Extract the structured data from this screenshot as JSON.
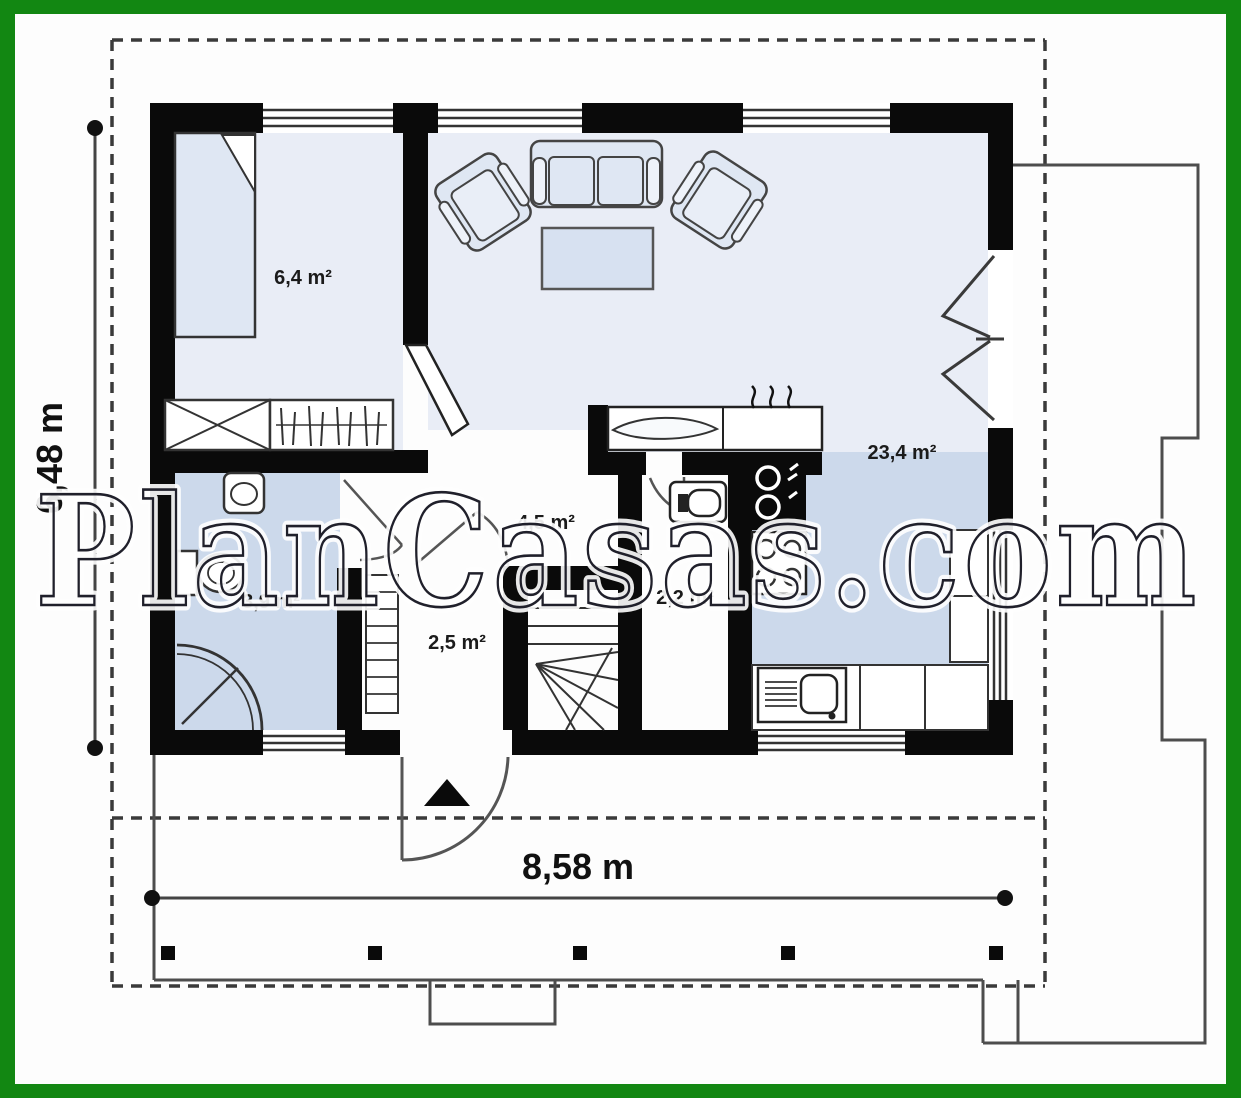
{
  "title": "House ground floor plan",
  "watermark": {
    "text": "PlanCasas.com"
  },
  "dimensions": {
    "width_label": "8,58 m",
    "height_label": "6,48 m"
  },
  "rooms": [
    {
      "id": "living-dining-kitchen",
      "area_label": "23,4 m²"
    },
    {
      "id": "bedroom",
      "area_label": "6,4 m²"
    },
    {
      "id": "hall",
      "area_label": "4,5 m²"
    },
    {
      "id": "bathroom",
      "area_label": "3,9 m²"
    },
    {
      "id": "entry-vestibule",
      "area_label": "2,5 m²"
    },
    {
      "id": "wc-pantry",
      "area_label": "2,2 m²"
    }
  ],
  "colors": {
    "frame_green": "#128712",
    "wall_black": "#0a0a0a",
    "floor_light": "#e9edf6",
    "floor_blue": "#ccd9eb",
    "line_gray": "#555555"
  }
}
